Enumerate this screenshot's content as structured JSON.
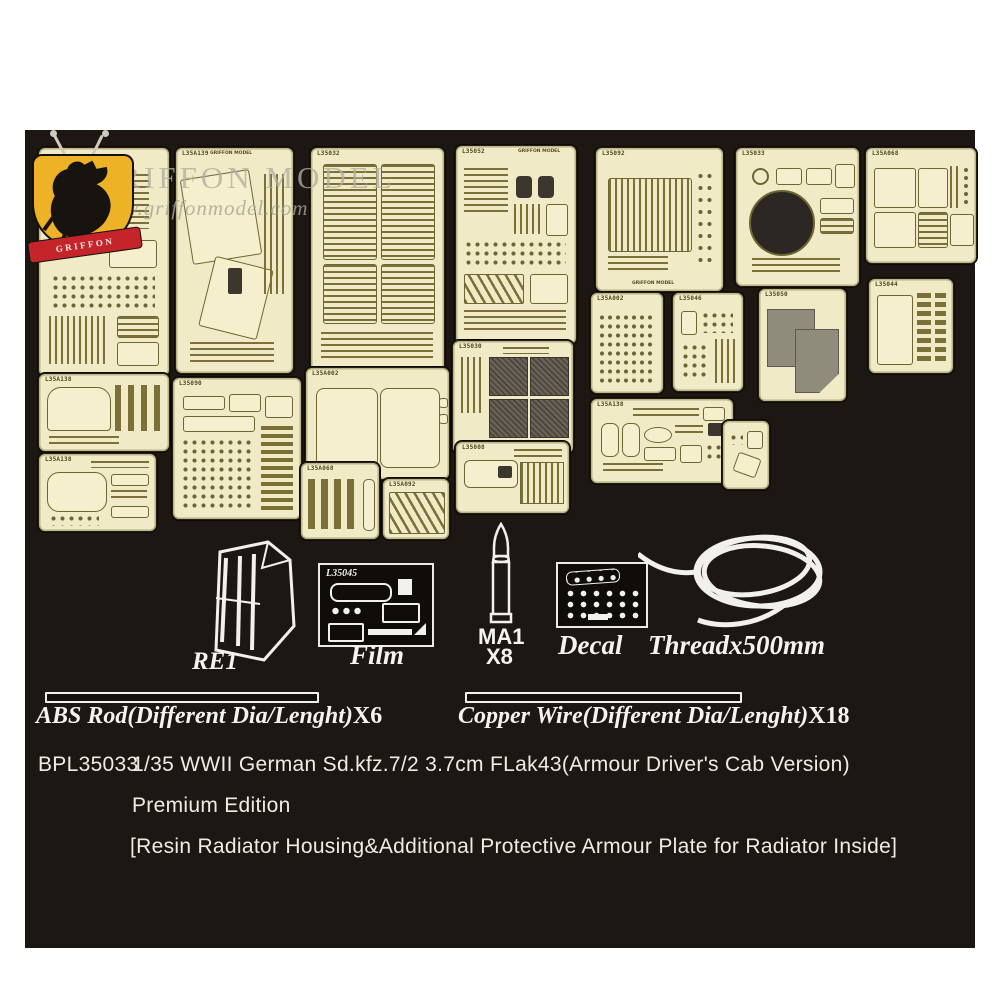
{
  "logo": {
    "brand": "GRIFFON MODEL",
    "website": "www.griffonmodel.com",
    "ribbon": "GRIFFON",
    "maker_mark": "GRIFFON MODEL"
  },
  "frets": [
    {
      "label": ""
    },
    {
      "label": "L35A139"
    },
    {
      "label": "L35032"
    },
    {
      "label": "L35052"
    },
    {
      "label": "L35092"
    },
    {
      "label": "L35033"
    },
    {
      "label": "L35A068"
    },
    {
      "label": "L35A002"
    },
    {
      "label": "L35046"
    },
    {
      "label": "L35050"
    },
    {
      "label": "L35044"
    },
    {
      "label": "L35A138"
    },
    {
      "label": "L35090"
    },
    {
      "label": "L35A002"
    },
    {
      "label": "L35030"
    },
    {
      "label": "L35A138"
    },
    {
      "label": ""
    },
    {
      "label": "L35A138"
    },
    {
      "label": "L35A068"
    },
    {
      "label": "L35A092"
    },
    {
      "label": "L35008"
    }
  ],
  "items": {
    "re1_label": "RE1",
    "film": {
      "sheet": "L35045",
      "caption": "Film"
    },
    "ma1": {
      "name": "MA1",
      "qty": "X8"
    },
    "decal_caption": "Decal",
    "thread_caption": "Threadx500mm"
  },
  "rods": {
    "abs": {
      "label": "ABS Rod(Different Dia/Lenght)",
      "count": "X6"
    },
    "copper": {
      "label": "Copper Wire(Different Dia/Lenght)",
      "count": "X18"
    }
  },
  "footer": {
    "sku": "BPL35033",
    "title": "1/35 WWII German Sd.kfz.7/2 3.7cm FLak43(Armour Driver's Cab Version)",
    "edition": "Premium Edition",
    "note": "[Resin Radiator Housing&Additional Protective Armour Plate for Radiator Inside]"
  },
  "colors": {
    "panel_background": "#1d1713",
    "fret_brass": "#f0eac6",
    "crest_yellow": "#eeb227",
    "crest_red": "#c5242b",
    "text_white": "#f5f3ef"
  }
}
